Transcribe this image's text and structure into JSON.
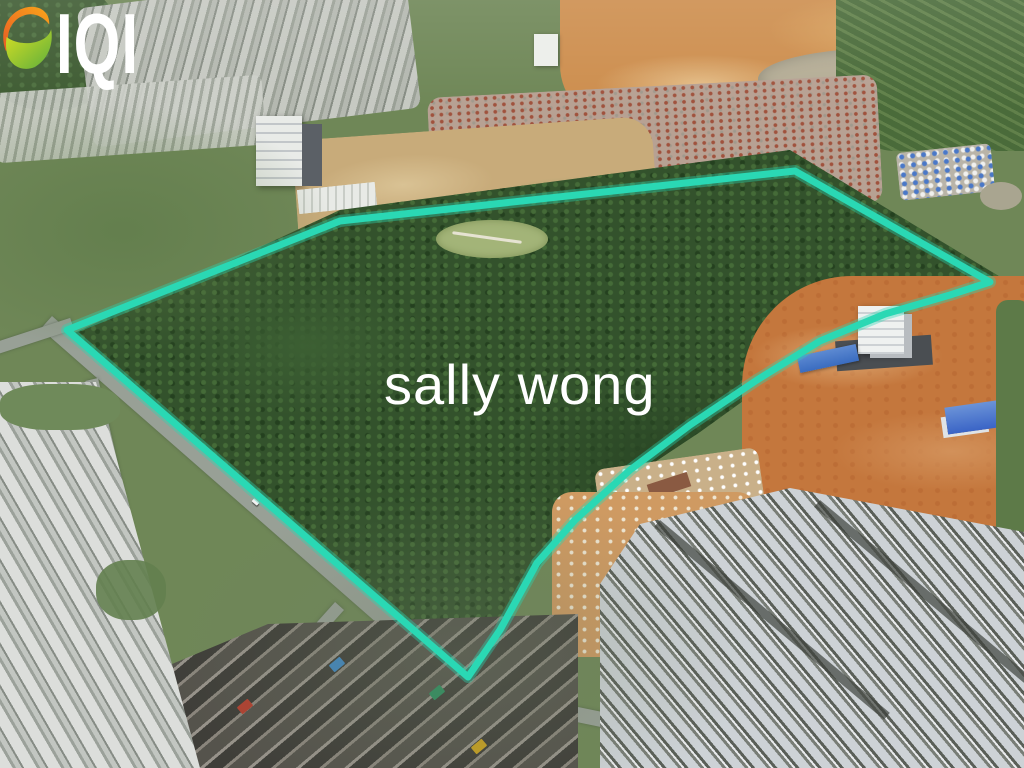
{
  "overlay": {
    "logo": {
      "text": "IQI",
      "color": "#ffffff",
      "icon": "iqi-swirl-icon",
      "icon_orange": "#f08021",
      "icon_green": "#8cc63f"
    },
    "watermark": {
      "text": "sally wong",
      "color": "#ffffff"
    },
    "boundary": {
      "color": "#2ad8b4",
      "path": "M 67,330 L 340,221 L 795,171 L 990,282 L 950,295 L 885,314 L 820,341 L 757,380 L 690,425 L 630,470 L 575,520 L 537,563 L 500,630 L 468,677 Z"
    }
  },
  "scene": {
    "type": "aerial-photograph",
    "colors": {
      "forest_green": "#33522c",
      "construction_orange": "#c4773d",
      "quarry_sand": "#cd8e4e",
      "road_gray": "#98a096",
      "field_green": "#6f8757",
      "roof_red": "#a0523d",
      "roof_gray_new": "#cdd2d6",
      "roof_dark_old": "#55534c",
      "house_white": "#dcdedb",
      "site_building_blue": "#3a6cc0"
    }
  }
}
